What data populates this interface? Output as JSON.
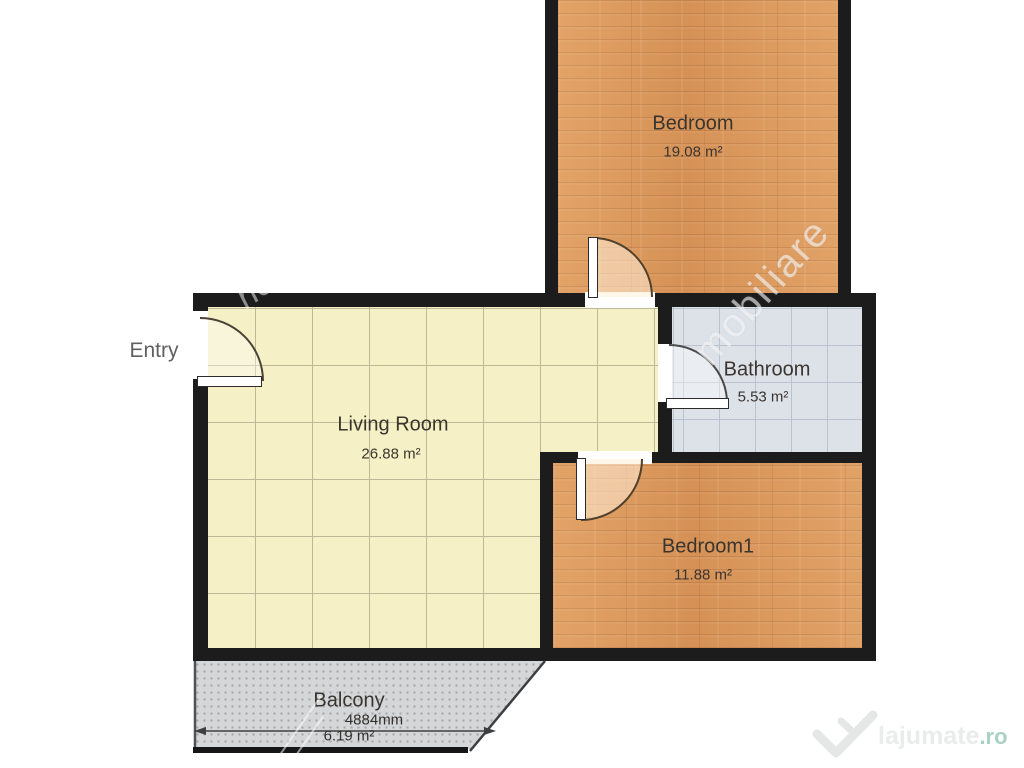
{
  "rooms": {
    "bedroom": {
      "label": "Bedroom",
      "area": "19.08 m²"
    },
    "living_room": {
      "label": "Living Room",
      "area": "26.88 m²"
    },
    "bathroom": {
      "label": "Bathroom",
      "area": "5.53 m²"
    },
    "bedroom1": {
      "label": "Bedroom1",
      "area": "11.88 m²"
    },
    "balcony": {
      "label": "Balcony",
      "area": "6.19 m²"
    }
  },
  "annotations": {
    "entry": "Entry",
    "balcony_width_mm": "4884mm"
  },
  "watermarks": {
    "diagonal_text": "mobiliare",
    "script_fragment": "ne",
    "brand": "lajumate",
    "brand_tld": ".ro"
  },
  "colors": {
    "wall": "#1c1c1c",
    "wood_floor": "#dc9a5e",
    "living_tile": "#f6f0c6",
    "bathroom_tile": "#dde2e9",
    "balcony_floor": "#d4d6d8",
    "brand_teal": "#a9d2c3"
  }
}
